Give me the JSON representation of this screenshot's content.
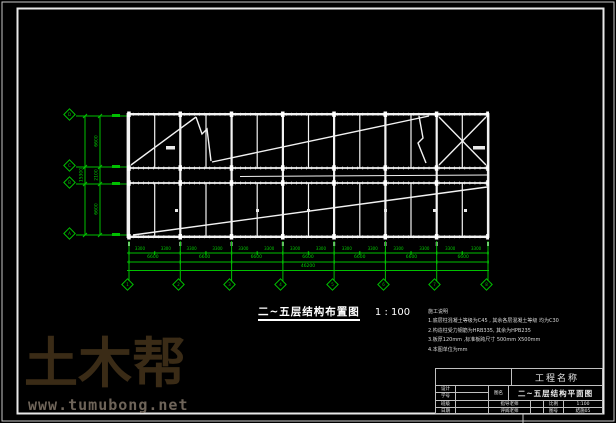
{
  "sheet": {
    "caption_title": "二~五层结构布置图",
    "caption_scale": "1 : 100"
  },
  "notes": {
    "header": "施工说明",
    "lines": [
      "1.底层柱混凝土等级为C45 , 其余各层混凝土等级 均为C30",
      "2.构造柱受力钢筋为HRB335, 其余为HPB235",
      "3.板厚120mm ,标准板跨尺寸 500mm X500mm",
      "4.本图单位为mm"
    ]
  },
  "axes": {
    "bottom": [
      "1",
      "2",
      "3",
      "4",
      "5",
      "6",
      "7",
      "8"
    ],
    "left": [
      "D",
      "C",
      "B",
      "A"
    ]
  },
  "dims": {
    "bottom": {
      "half": "3300",
      "bay": "6600",
      "total": "46200"
    },
    "left": {
      "segments": [
        "6600",
        "2100",
        "6600"
      ],
      "total": "15300"
    }
  },
  "title_block": {
    "project_label": "工程名称",
    "design_label": "设计",
    "student_label": "学号",
    "class_label": "班级",
    "date_label": "日期",
    "drawing_name_label": "图名",
    "drawing_name": "二~五层结构平面图",
    "advisor_label": "指导老师",
    "reviewer_label": "评阅老师",
    "scale_label": "比例",
    "scale_value": "1:100",
    "number_label": "图号",
    "number_value": "结施05"
  },
  "watermark": {
    "logo": "土木帮",
    "url": "www.tumubong.net"
  },
  "colors": {
    "background": "#000000",
    "cad_green": "#00c000",
    "line_white": "#f2f2f2",
    "watermark_logo": "#3a2b16",
    "watermark_url": "#6e6459"
  }
}
